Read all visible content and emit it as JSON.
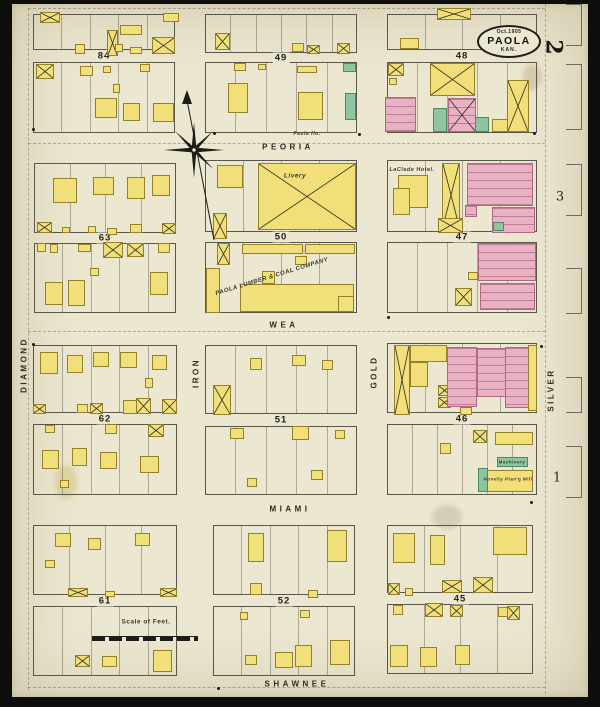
{
  "map": {
    "title_oval": {
      "date": "Oct.1905",
      "city": "PAOLA",
      "state": "KAN."
    },
    "sheet_number": "2",
    "adjacent_sheets": [
      {
        "n": "3",
        "x": 560,
        "y": 197
      },
      {
        "n": "1",
        "x": 557,
        "y": 478
      }
    ]
  },
  "streets": {
    "horizontal": [
      {
        "name": "PEORIA",
        "x": 288,
        "y": 147
      },
      {
        "name": "WEA",
        "x": 284,
        "y": 325
      },
      {
        "name": "MIAMI",
        "x": 290,
        "y": 509
      },
      {
        "name": "SHAWNEE",
        "x": 297,
        "y": 684
      }
    ],
    "vertical": [
      {
        "name": "DIAMOND",
        "x": 24,
        "y": 365
      },
      {
        "name": "IRON",
        "x": 196,
        "y": 373
      },
      {
        "name": "GOLD",
        "x": 374,
        "y": 372
      },
      {
        "name": "SILVER",
        "x": 551,
        "y": 390
      }
    ]
  },
  "blocks": [
    {
      "num": "84",
      "x": 33,
      "w": 142,
      "topY": 14,
      "topH": 36,
      "botY": 62,
      "botH": 71,
      "lt": 5,
      "lb": 5
    },
    {
      "num": "49",
      "x": 205,
      "w": 152,
      "topY": 14,
      "topH": 39,
      "botY": 62,
      "botH": 71,
      "lt": 6,
      "lb": 5
    },
    {
      "num": "48",
      "x": 387,
      "w": 150,
      "topY": 14,
      "topH": 36,
      "botY": 62,
      "botH": 71,
      "lt": 4,
      "lb": 5
    },
    {
      "num": "63",
      "x": 34,
      "w": 142,
      "topY": 163,
      "topH": 70,
      "botY": 243,
      "botH": 70,
      "lt": 4,
      "lb": 5
    },
    {
      "num": "50",
      "x": 205,
      "w": 152,
      "topY": 160,
      "topH": 72,
      "botY": 242,
      "botH": 71,
      "lt": 4,
      "lb": 4
    },
    {
      "num": "47",
      "x": 387,
      "w": 150,
      "topY": 160,
      "topH": 72,
      "botY": 242,
      "botH": 71,
      "lt": 4,
      "lb": 5
    },
    {
      "num": "62",
      "x": 33,
      "w": 144,
      "topY": 345,
      "topH": 68,
      "botY": 424,
      "botH": 71,
      "lt": 5,
      "lb": 5
    },
    {
      "num": "51",
      "x": 205,
      "w": 152,
      "topY": 345,
      "topH": 69,
      "botY": 426,
      "botH": 69,
      "lt": 5,
      "lb": 5
    },
    {
      "num": "46",
      "x": 387,
      "w": 150,
      "topY": 343,
      "topH": 70,
      "botY": 424,
      "botH": 71,
      "lt": 4,
      "lb": 6
    },
    {
      "num": "61",
      "x": 33,
      "w": 144,
      "topY": 525,
      "topH": 70,
      "botY": 606,
      "botH": 70,
      "lt": 4,
      "lb": 5
    },
    {
      "num": "52",
      "x": 213,
      "w": 142,
      "topY": 525,
      "topH": 70,
      "botY": 606,
      "botH": 70,
      "lt": 5,
      "lb": 5
    },
    {
      "num": "45",
      "x": 387,
      "w": 146,
      "topY": 525,
      "topH": 68,
      "botY": 604,
      "botH": 70,
      "lt": 4,
      "lb": 4
    }
  ],
  "buildings": [
    [
      40,
      12,
      20,
      11,
      "y",
      1
    ],
    [
      120,
      25,
      22,
      10,
      "y",
      0
    ],
    [
      107,
      30,
      11,
      26,
      "y",
      1
    ],
    [
      163,
      13,
      16,
      9,
      "y",
      0
    ],
    [
      75,
      44,
      10,
      10,
      "y",
      0
    ],
    [
      115,
      44,
      8,
      8,
      "y",
      0
    ],
    [
      130,
      47,
      12,
      7,
      "y",
      0
    ],
    [
      152,
      37,
      23,
      17,
      "y",
      1
    ],
    [
      36,
      64,
      18,
      15,
      "y",
      1
    ],
    [
      80,
      66,
      13,
      10,
      "y",
      0
    ],
    [
      140,
      64,
      10,
      8,
      "y",
      0
    ],
    [
      103,
      66,
      8,
      7,
      "y",
      0
    ],
    [
      95,
      98,
      22,
      20,
      "y",
      0
    ],
    [
      123,
      103,
      17,
      18,
      "y",
      0
    ],
    [
      153,
      103,
      21,
      19,
      "y",
      0
    ],
    [
      113,
      84,
      7,
      9,
      "y",
      0
    ],
    [
      215,
      33,
      15,
      17,
      "y",
      1
    ],
    [
      292,
      43,
      12,
      9,
      "y",
      0
    ],
    [
      307,
      45,
      13,
      9,
      "y",
      1
    ],
    [
      337,
      43,
      13,
      11,
      "y",
      1
    ],
    [
      234,
      63,
      12,
      8,
      "y",
      0
    ],
    [
      297,
      66,
      20,
      7,
      "y",
      0
    ],
    [
      343,
      63,
      13,
      9,
      "g",
      0
    ],
    [
      228,
      83,
      20,
      30,
      "y",
      0
    ],
    [
      298,
      92,
      25,
      28,
      "y",
      0
    ],
    [
      345,
      93,
      11,
      27,
      "g",
      0
    ],
    [
      258,
      64,
      8,
      6,
      "y",
      0
    ],
    [
      437,
      8,
      34,
      12,
      "y",
      1
    ],
    [
      400,
      38,
      19,
      11,
      "y",
      0
    ],
    [
      388,
      63,
      16,
      13,
      "y",
      1
    ],
    [
      389,
      78,
      8,
      7,
      "y",
      0
    ],
    [
      385,
      97,
      31,
      35,
      "p",
      0
    ],
    [
      430,
      63,
      45,
      33,
      "y",
      1
    ],
    [
      448,
      98,
      28,
      34,
      "p",
      1
    ],
    [
      433,
      108,
      14,
      24,
      "g",
      0
    ],
    [
      475,
      117,
      14,
      15,
      "g",
      0
    ],
    [
      492,
      119,
      18,
      13,
      "y",
      0
    ],
    [
      507,
      80,
      22,
      52,
      "y",
      1
    ],
    [
      53,
      178,
      24,
      25,
      "y",
      0
    ],
    [
      93,
      177,
      21,
      18,
      "y",
      0
    ],
    [
      127,
      177,
      18,
      22,
      "y",
      0
    ],
    [
      152,
      175,
      18,
      21,
      "y",
      0
    ],
    [
      37,
      222,
      15,
      11,
      "y",
      1
    ],
    [
      62,
      227,
      8,
      6,
      "y",
      0
    ],
    [
      88,
      226,
      8,
      7,
      "y",
      0
    ],
    [
      107,
      228,
      10,
      7,
      "y",
      0
    ],
    [
      130,
      224,
      12,
      9,
      "y",
      0
    ],
    [
      162,
      223,
      14,
      11,
      "y",
      1
    ],
    [
      37,
      243,
      9,
      9,
      "y",
      0
    ],
    [
      50,
      244,
      8,
      9,
      "y",
      0
    ],
    [
      78,
      244,
      13,
      8,
      "y",
      0
    ],
    [
      103,
      242,
      20,
      16,
      "y",
      1
    ],
    [
      127,
      243,
      17,
      14,
      "y",
      1
    ],
    [
      158,
      243,
      12,
      10,
      "y",
      0
    ],
    [
      45,
      282,
      18,
      23,
      "y",
      0
    ],
    [
      68,
      280,
      17,
      26,
      "y",
      0
    ],
    [
      150,
      272,
      18,
      23,
      "y",
      0
    ],
    [
      90,
      268,
      9,
      8,
      "y",
      0
    ],
    [
      217,
      165,
      26,
      23,
      "y",
      0
    ],
    [
      258,
      163,
      98,
      67,
      "y",
      1
    ],
    [
      213,
      213,
      14,
      26,
      "y",
      1
    ],
    [
      217,
      243,
      13,
      22,
      "y",
      1
    ],
    [
      242,
      244,
      61,
      10,
      "y",
      0
    ],
    [
      305,
      244,
      50,
      10,
      "y",
      0
    ],
    [
      295,
      256,
      12,
      9,
      "y",
      0
    ],
    [
      262,
      271,
      13,
      13,
      "y",
      0
    ],
    [
      206,
      268,
      14,
      45,
      "y",
      0
    ],
    [
      240,
      284,
      114,
      28,
      "y",
      0
    ],
    [
      338,
      296,
      16,
      16,
      "y",
      0
    ],
    [
      398,
      175,
      30,
      33,
      "y",
      0
    ],
    [
      393,
      188,
      17,
      27,
      "y",
      0
    ],
    [
      442,
      163,
      18,
      64,
      "y",
      1
    ],
    [
      438,
      218,
      25,
      15,
      "y",
      1
    ],
    [
      467,
      163,
      66,
      43,
      "p",
      0
    ],
    [
      492,
      207,
      43,
      26,
      "p",
      0
    ],
    [
      465,
      205,
      12,
      12,
      "p",
      0
    ],
    [
      493,
      222,
      11,
      9,
      "g",
      0
    ],
    [
      478,
      243,
      58,
      38,
      "p",
      0
    ],
    [
      480,
      283,
      55,
      27,
      "p",
      0
    ],
    [
      455,
      288,
      17,
      18,
      "y",
      1
    ],
    [
      468,
      272,
      10,
      8,
      "y",
      0
    ],
    [
      40,
      352,
      18,
      22,
      "y",
      0
    ],
    [
      67,
      355,
      16,
      18,
      "y",
      0
    ],
    [
      93,
      352,
      16,
      15,
      "y",
      0
    ],
    [
      120,
      352,
      17,
      16,
      "y",
      0
    ],
    [
      152,
      355,
      15,
      15,
      "y",
      0
    ],
    [
      145,
      378,
      8,
      10,
      "y",
      0
    ],
    [
      33,
      404,
      13,
      10,
      "y",
      1
    ],
    [
      77,
      404,
      11,
      9,
      "y",
      0
    ],
    [
      90,
      403,
      13,
      11,
      "y",
      1
    ],
    [
      123,
      400,
      14,
      14,
      "y",
      0
    ],
    [
      136,
      398,
      15,
      16,
      "y",
      1
    ],
    [
      162,
      399,
      15,
      15,
      "y",
      1
    ],
    [
      45,
      425,
      10,
      8,
      "y",
      0
    ],
    [
      105,
      424,
      12,
      10,
      "y",
      0
    ],
    [
      148,
      424,
      16,
      13,
      "y",
      1
    ],
    [
      42,
      450,
      17,
      19,
      "y",
      0
    ],
    [
      72,
      448,
      15,
      18,
      "y",
      0
    ],
    [
      100,
      452,
      17,
      17,
      "y",
      0
    ],
    [
      140,
      456,
      19,
      17,
      "y",
      0
    ],
    [
      60,
      480,
      9,
      8,
      "y",
      0
    ],
    [
      213,
      385,
      18,
      30,
      "y",
      1
    ],
    [
      250,
      358,
      12,
      12,
      "y",
      0
    ],
    [
      292,
      355,
      14,
      11,
      "y",
      0
    ],
    [
      322,
      360,
      11,
      10,
      "y",
      0
    ],
    [
      230,
      428,
      14,
      11,
      "y",
      0
    ],
    [
      292,
      426,
      17,
      14,
      "y",
      0
    ],
    [
      311,
      470,
      12,
      10,
      "y",
      0
    ],
    [
      247,
      478,
      10,
      9,
      "y",
      0
    ],
    [
      335,
      430,
      10,
      9,
      "y",
      0
    ],
    [
      394,
      345,
      16,
      70,
      "y",
      1
    ],
    [
      410,
      345,
      37,
      17,
      "y",
      0
    ],
    [
      410,
      362,
      18,
      25,
      "y",
      0
    ],
    [
      438,
      385,
      13,
      11,
      "y",
      1
    ],
    [
      438,
      397,
      13,
      11,
      "y",
      1
    ],
    [
      447,
      347,
      30,
      60,
      "p",
      0
    ],
    [
      477,
      348,
      30,
      49,
      "p",
      0
    ],
    [
      505,
      347,
      25,
      61,
      "p",
      0
    ],
    [
      528,
      345,
      9,
      66,
      "y",
      0
    ],
    [
      460,
      407,
      12,
      8,
      "y",
      0
    ],
    [
      473,
      430,
      14,
      13,
      "y",
      1
    ],
    [
      495,
      432,
      38,
      13,
      "y",
      0
    ],
    [
      497,
      457,
      31,
      10,
      "g",
      0
    ],
    [
      485,
      470,
      48,
      22,
      "y",
      0
    ],
    [
      478,
      468,
      10,
      24,
      "g",
      0
    ],
    [
      440,
      443,
      11,
      11,
      "y",
      0
    ],
    [
      55,
      533,
      16,
      14,
      "y",
      0
    ],
    [
      88,
      538,
      13,
      12,
      "y",
      0
    ],
    [
      135,
      533,
      15,
      13,
      "y",
      0
    ],
    [
      45,
      560,
      10,
      8,
      "y",
      0
    ],
    [
      68,
      588,
      20,
      9,
      "y",
      1
    ],
    [
      105,
      591,
      10,
      6,
      "y",
      0
    ],
    [
      160,
      588,
      17,
      9,
      "y",
      1
    ],
    [
      75,
      655,
      15,
      12,
      "y",
      1
    ],
    [
      102,
      656,
      15,
      11,
      "y",
      0
    ],
    [
      153,
      650,
      19,
      22,
      "y",
      0
    ],
    [
      248,
      533,
      16,
      29,
      "y",
      0
    ],
    [
      327,
      530,
      20,
      32,
      "y",
      0
    ],
    [
      250,
      583,
      12,
      12,
      "y",
      0
    ],
    [
      308,
      590,
      10,
      8,
      "y",
      0
    ],
    [
      240,
      612,
      8,
      8,
      "y",
      0
    ],
    [
      300,
      610,
      10,
      8,
      "y",
      0
    ],
    [
      245,
      655,
      12,
      10,
      "y",
      0
    ],
    [
      275,
      652,
      18,
      16,
      "y",
      0
    ],
    [
      295,
      645,
      17,
      22,
      "y",
      0
    ],
    [
      330,
      640,
      20,
      25,
      "y",
      0
    ],
    [
      393,
      533,
      22,
      30,
      "y",
      0
    ],
    [
      430,
      535,
      15,
      30,
      "y",
      0
    ],
    [
      493,
      527,
      34,
      28,
      "y",
      0
    ],
    [
      388,
      583,
      12,
      12,
      "y",
      1
    ],
    [
      405,
      588,
      8,
      8,
      "y",
      0
    ],
    [
      442,
      580,
      20,
      13,
      "y",
      1
    ],
    [
      473,
      577,
      20,
      16,
      "y",
      1
    ],
    [
      393,
      605,
      10,
      10,
      "y",
      0
    ],
    [
      425,
      603,
      18,
      14,
      "y",
      1
    ],
    [
      450,
      605,
      13,
      12,
      "y",
      1
    ],
    [
      498,
      607,
      12,
      10,
      "y",
      0
    ],
    [
      507,
      606,
      13,
      14,
      "y",
      1
    ],
    [
      390,
      645,
      18,
      22,
      "y",
      0
    ],
    [
      420,
      647,
      17,
      20,
      "y",
      0
    ],
    [
      455,
      645,
      15,
      20,
      "y",
      0
    ]
  ],
  "labels": [
    {
      "text": "Livery",
      "x": 295,
      "y": 176,
      "size": 6.5,
      "italic": 1,
      "rot": 0
    },
    {
      "text": "PAOLA LUMBER & COAL COMPANY",
      "x": 272,
      "y": 277,
      "size": 6,
      "italic": 1,
      "rot": -17
    },
    {
      "text": "LaClede Hotel.",
      "x": 412,
      "y": 170,
      "size": 5.5,
      "italic": 1,
      "rot": 0
    },
    {
      "text": "Paola Ho.",
      "x": 307,
      "y": 134,
      "size": 5,
      "italic": 1,
      "rot": 0
    },
    {
      "text": "Machinery",
      "x": 512,
      "y": 462,
      "size": 4.5,
      "italic": 0,
      "rot": 0
    },
    {
      "text": "Novelty Plan'g Mill",
      "x": 508,
      "y": 479,
      "size": 4.5,
      "italic": 0,
      "rot": 0
    },
    {
      "text": "Scale of Feet.",
      "x": 146,
      "y": 622,
      "size": 6.5,
      "italic": 0,
      "rot": 0
    }
  ],
  "brackets": [
    {
      "y": 4,
      "h": 40
    },
    {
      "y": 64,
      "h": 64
    },
    {
      "y": 164,
      "h": 50
    },
    {
      "y": 268,
      "h": 44
    },
    {
      "y": 377,
      "h": 34
    },
    {
      "y": 446,
      "h": 50
    }
  ],
  "dots": [
    [
      32,
      128
    ],
    [
      213,
      132
    ],
    [
      358,
      133
    ],
    [
      533,
      132
    ],
    [
      32,
      343
    ],
    [
      540,
      345
    ],
    [
      387,
      316
    ],
    [
      530,
      501
    ],
    [
      217,
      687
    ]
  ],
  "matchlines": [
    {
      "dir": "h",
      "x": 28,
      "y": 8,
      "len": 517
    },
    {
      "dir": "h",
      "x": 28,
      "y": 143,
      "len": 517
    },
    {
      "dir": "h",
      "x": 28,
      "y": 331,
      "len": 517
    },
    {
      "dir": "h",
      "x": 28,
      "y": 687,
      "len": 517
    },
    {
      "dir": "v",
      "x": 28,
      "y": 8,
      "len": 682
    },
    {
      "dir": "v",
      "x": 545,
      "y": 4,
      "len": 690
    }
  ],
  "stains": [
    {
      "x": 55,
      "y": 465,
      "w": 22,
      "h": 34,
      "c": "rgba(190,170,60,0.30)"
    },
    {
      "x": 432,
      "y": 505,
      "w": 30,
      "h": 24,
      "c": "rgba(130,120,95,0.22)"
    },
    {
      "x": 523,
      "y": 64,
      "w": 18,
      "h": 26,
      "c": "rgba(160,120,70,0.25)"
    },
    {
      "x": 298,
      "y": 246,
      "w": 12,
      "h": 9,
      "c": "rgba(150,130,80,0.25)"
    }
  ]
}
